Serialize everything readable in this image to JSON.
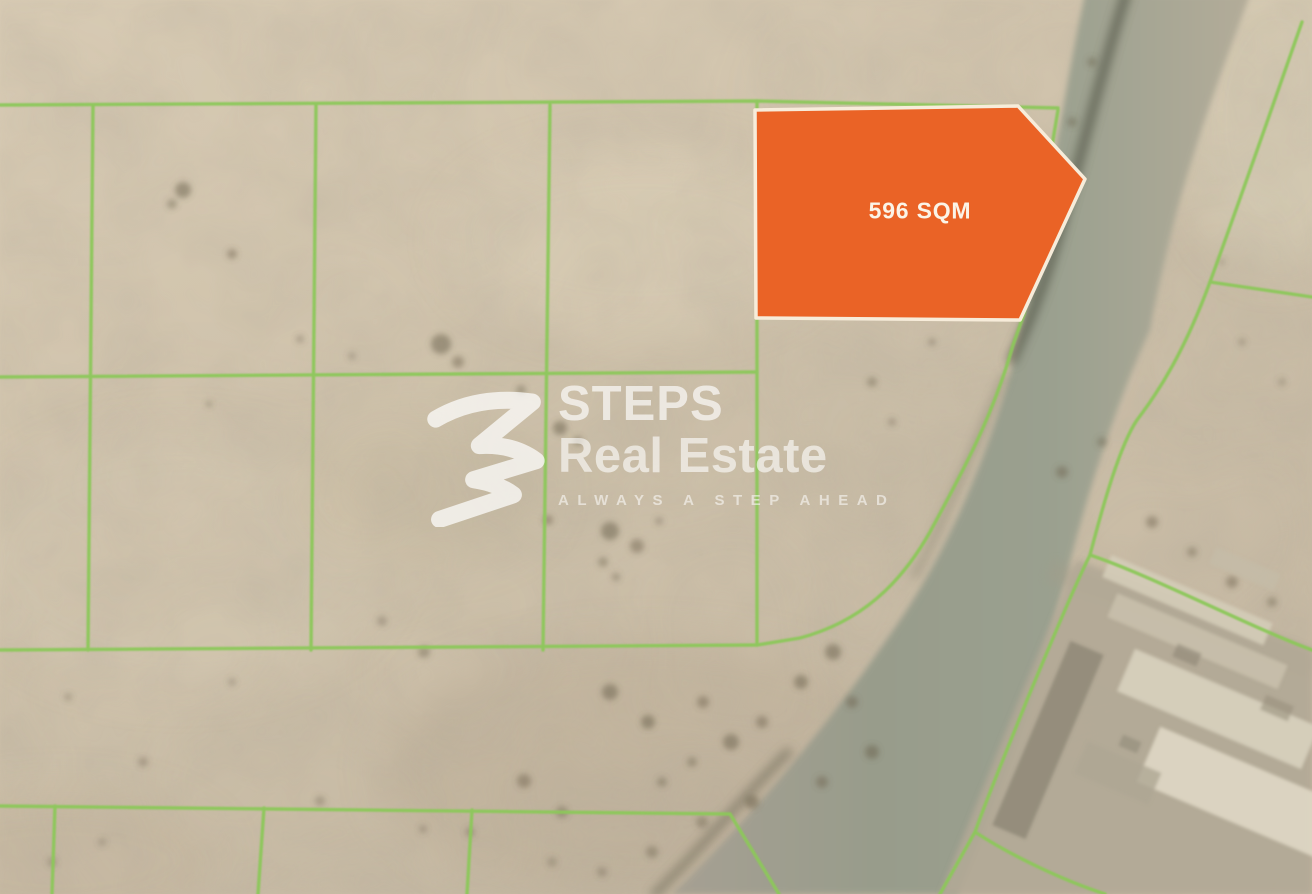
{
  "map": {
    "plot_label": "596 SQM",
    "watermark": {
      "brand_top": "STEPS",
      "brand_bottom": "Real Estate",
      "tagline": "ALWAYS A STEP AHEAD"
    },
    "colors": {
      "plot_fill": "#EA6326",
      "plot_border": "#F7ECDA",
      "boundary_green": "#8CC85A",
      "sand": "#CFC2AB",
      "road": "#9AA08F",
      "watermark_white": "#FFFFFF"
    }
  }
}
